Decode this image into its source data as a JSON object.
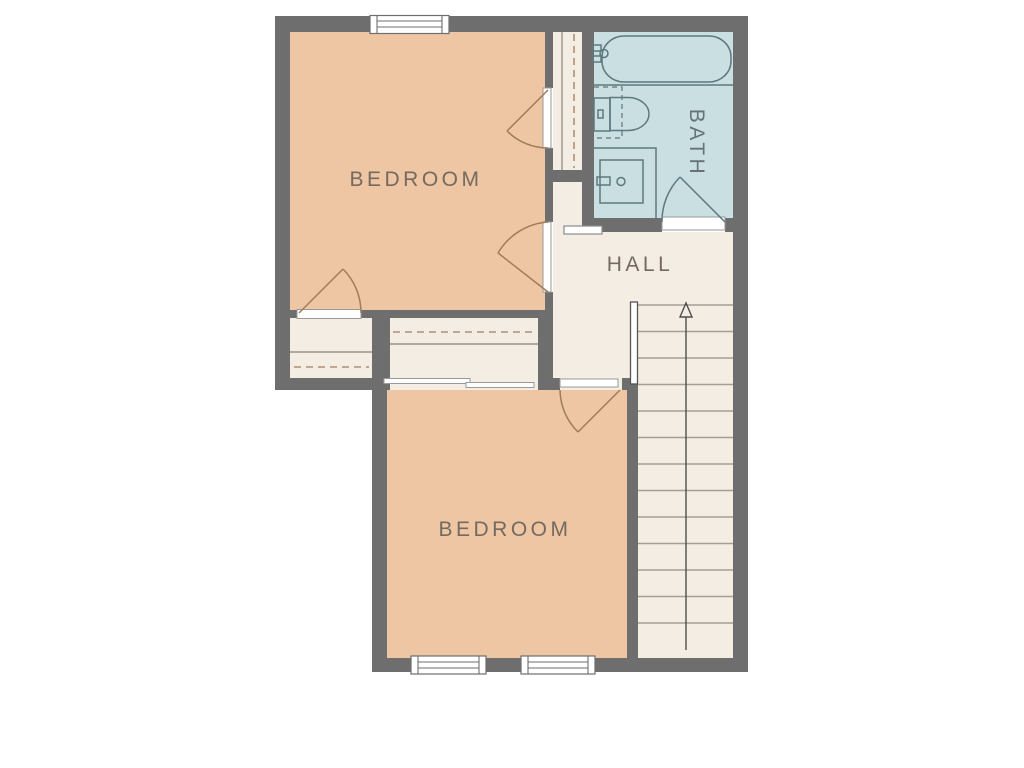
{
  "document": {
    "type": "floor-plan",
    "floor": "upper"
  },
  "colors": {
    "background": "#ffffff",
    "wall": "#6e6e6e",
    "bedroom_fill": "#eec6a3",
    "bath_fill": "#cadfe1",
    "floor_fill": "#f4ede3",
    "door_arc": "#9f7c5d",
    "bath_fixture_line": "#5d787e",
    "closet_rod_dash": "#b08f74",
    "detail_line": "#9b948a",
    "label_text": "#746a5f",
    "bath_label_text": "#667276"
  },
  "rooms": {
    "bedroom_top": {
      "label": "BEDROOM"
    },
    "bedroom_bottom": {
      "label": "BEDROOM"
    },
    "bath": {
      "label": "BATH"
    },
    "hall": {
      "label": "HALL"
    }
  },
  "fixtures": {
    "bathtub": "bathtub-with-faucet",
    "toilet": "toilet-with-clearance-box",
    "vanity": "sink-vanity",
    "stairs": {
      "direction": "up",
      "tread_count": 13
    },
    "closet_rods": 3,
    "swing_doors": 5,
    "sliding_door_panels": 2,
    "windows": 3
  }
}
